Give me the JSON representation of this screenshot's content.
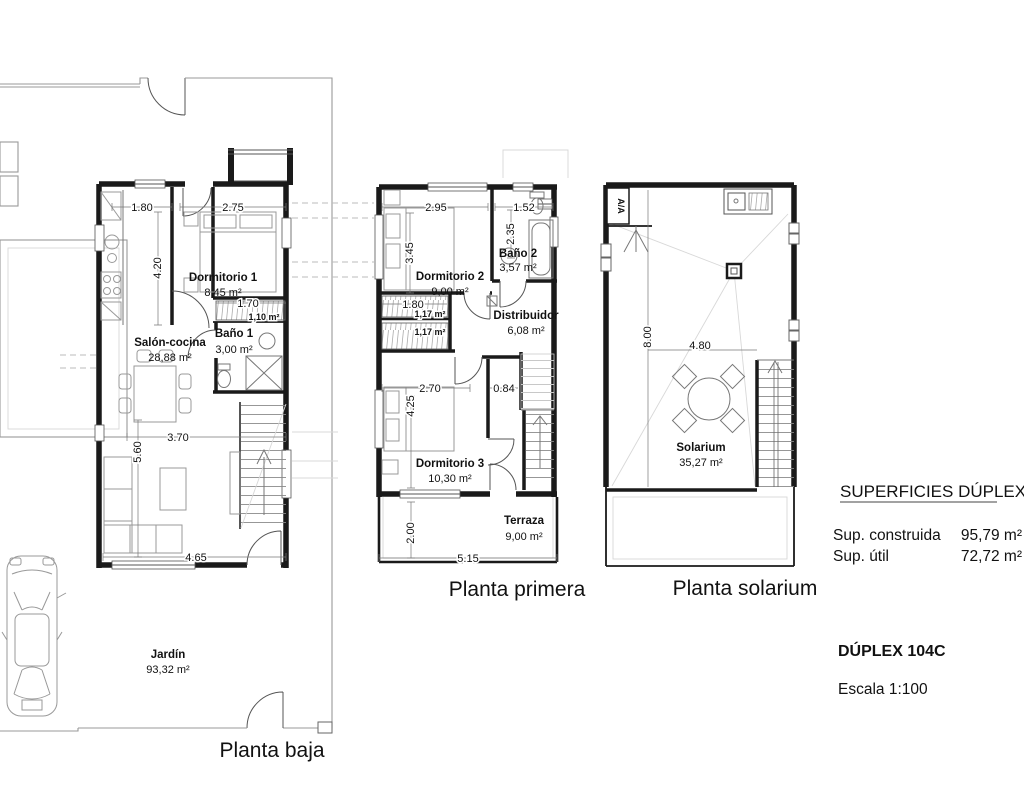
{
  "drawing": {
    "background": "#ffffff",
    "ink": "#1a1a1a"
  },
  "plans": {
    "baja": {
      "title": "Planta baja",
      "rooms": {
        "salon": {
          "name": "Salón-cocina",
          "area": "28,88 m²"
        },
        "dorm1": {
          "name": "Dormitorio 1",
          "area": "8,45 m²"
        },
        "bano1": {
          "name": "Baño 1",
          "area": "3,00 m²"
        },
        "armario": {
          "area": "1,10 m²"
        },
        "jardin": {
          "name": "Jardín",
          "area": "93,32 m²"
        }
      },
      "dims": {
        "entry_width": "1.80",
        "dorm1_width": "2.75",
        "kitchen_depth": "4.20",
        "armario_width": "1.70",
        "salon_width": "3.70",
        "salon_depth": "5.60",
        "salon_bottom": "4.65"
      }
    },
    "primera": {
      "title": "Planta primera",
      "rooms": {
        "dorm2": {
          "name": "Dormitorio 2",
          "area": "9,00 m²"
        },
        "bano2": {
          "name": "Baño 2",
          "area": "3,57 m²"
        },
        "distribuidor": {
          "name": "Distribuidor",
          "area": "6,08 m²"
        },
        "dorm3": {
          "name": "Dormitorio 3",
          "area": "10,30 m²"
        },
        "terraza": {
          "name": "Terraza",
          "area": "9,00 m²"
        },
        "armario1": {
          "area": "1,17 m²"
        },
        "armario2": {
          "area": "1,17 m²"
        }
      },
      "dims": {
        "dorm2_width": "2.95",
        "bano2_width": "1.52",
        "dorm2_depth": "3.45",
        "bano2_depth": "2.35",
        "armario_width": "1.80",
        "dorm3_width": "2.70",
        "hall_width": "0.84",
        "dorm3_depth": "4.25",
        "terraza_depth": "2.00",
        "terraza_width": "5.15"
      }
    },
    "solarium": {
      "title": "Planta solarium",
      "rooms": {
        "solarium": {
          "name": "Solarium",
          "area": "35,27 m²"
        }
      },
      "dims": {
        "width": "4.80",
        "depth": "8.00"
      },
      "labels": {
        "ac_unit": "A/A"
      }
    }
  },
  "info": {
    "superficies_heading": "SUPERFICIES DÚPLEX",
    "construida_label": "Sup. construida",
    "construida_value": "95,79 m²",
    "util_label": "Sup. útil",
    "util_value": "72,72 m²",
    "duplex_code": "DÚPLEX 104C",
    "escala": "Escala 1:100"
  }
}
